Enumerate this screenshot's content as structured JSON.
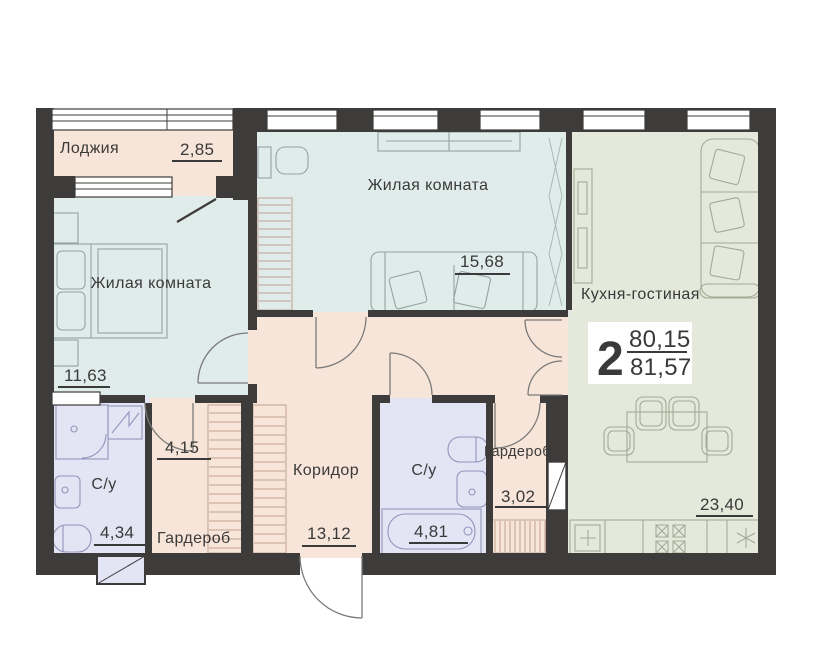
{
  "plan": {
    "badge": {
      "number": "2",
      "area_upper": "80,15",
      "area_lower": "81,57"
    },
    "rooms": {
      "loggia": {
        "name": "Лоджия",
        "area": "2,85"
      },
      "bedroom": {
        "name": "Жилая комната",
        "area": "11,63"
      },
      "living_room": {
        "name": "Жилая комната",
        "area": "15,68"
      },
      "kitchen_living": {
        "name": "Кухня-гостиная",
        "area": "23,40"
      },
      "bathroom_1": {
        "name": "С/у",
        "area": "4,34"
      },
      "wardrobe_1": {
        "name": "Гардероб",
        "area": "4,15"
      },
      "corridor": {
        "name": "Коридор",
        "area": "13,12"
      },
      "bathroom_2": {
        "name": "С/у",
        "area": "4,81"
      },
      "wardrobe_2": {
        "name": "Гардероб",
        "area": "3,02"
      }
    },
    "colors": {
      "wall": "#3e3c3b",
      "floor_warm": "#f8e5d9",
      "floor_room": "#dfecea",
      "floor_kitchen": "#e4e9dc",
      "floor_bath": "#e3e4f4",
      "text": "#3a3a3a"
    }
  }
}
